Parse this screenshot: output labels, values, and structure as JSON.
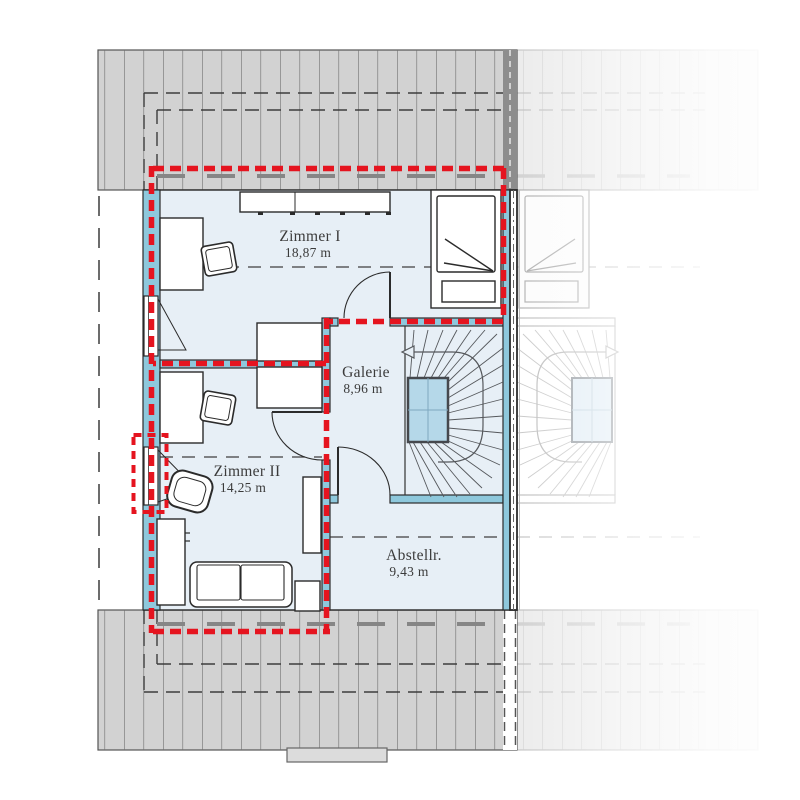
{
  "rooms": [
    {
      "name": "Zimmer I",
      "area": "18,87 m"
    },
    {
      "name": "Zimmer II",
      "area": "14,25 m"
    },
    {
      "name": "Galerie",
      "area": "8,96 m"
    },
    {
      "name": "Abstellr.",
      "area": "9,43 m"
    }
  ],
  "icons": {
    "stair_arrow_main": "arrow-left-icon",
    "stair_arrow_neighbor": "arrow-right-icon"
  },
  "colors": {
    "highlight_red": "#e5141f",
    "wall_blue": "#8ec8dc",
    "floor_blue": "#e7eff6",
    "stairwell_blue": "#b5d8e9",
    "roof_gray": "#d2d2d2"
  }
}
